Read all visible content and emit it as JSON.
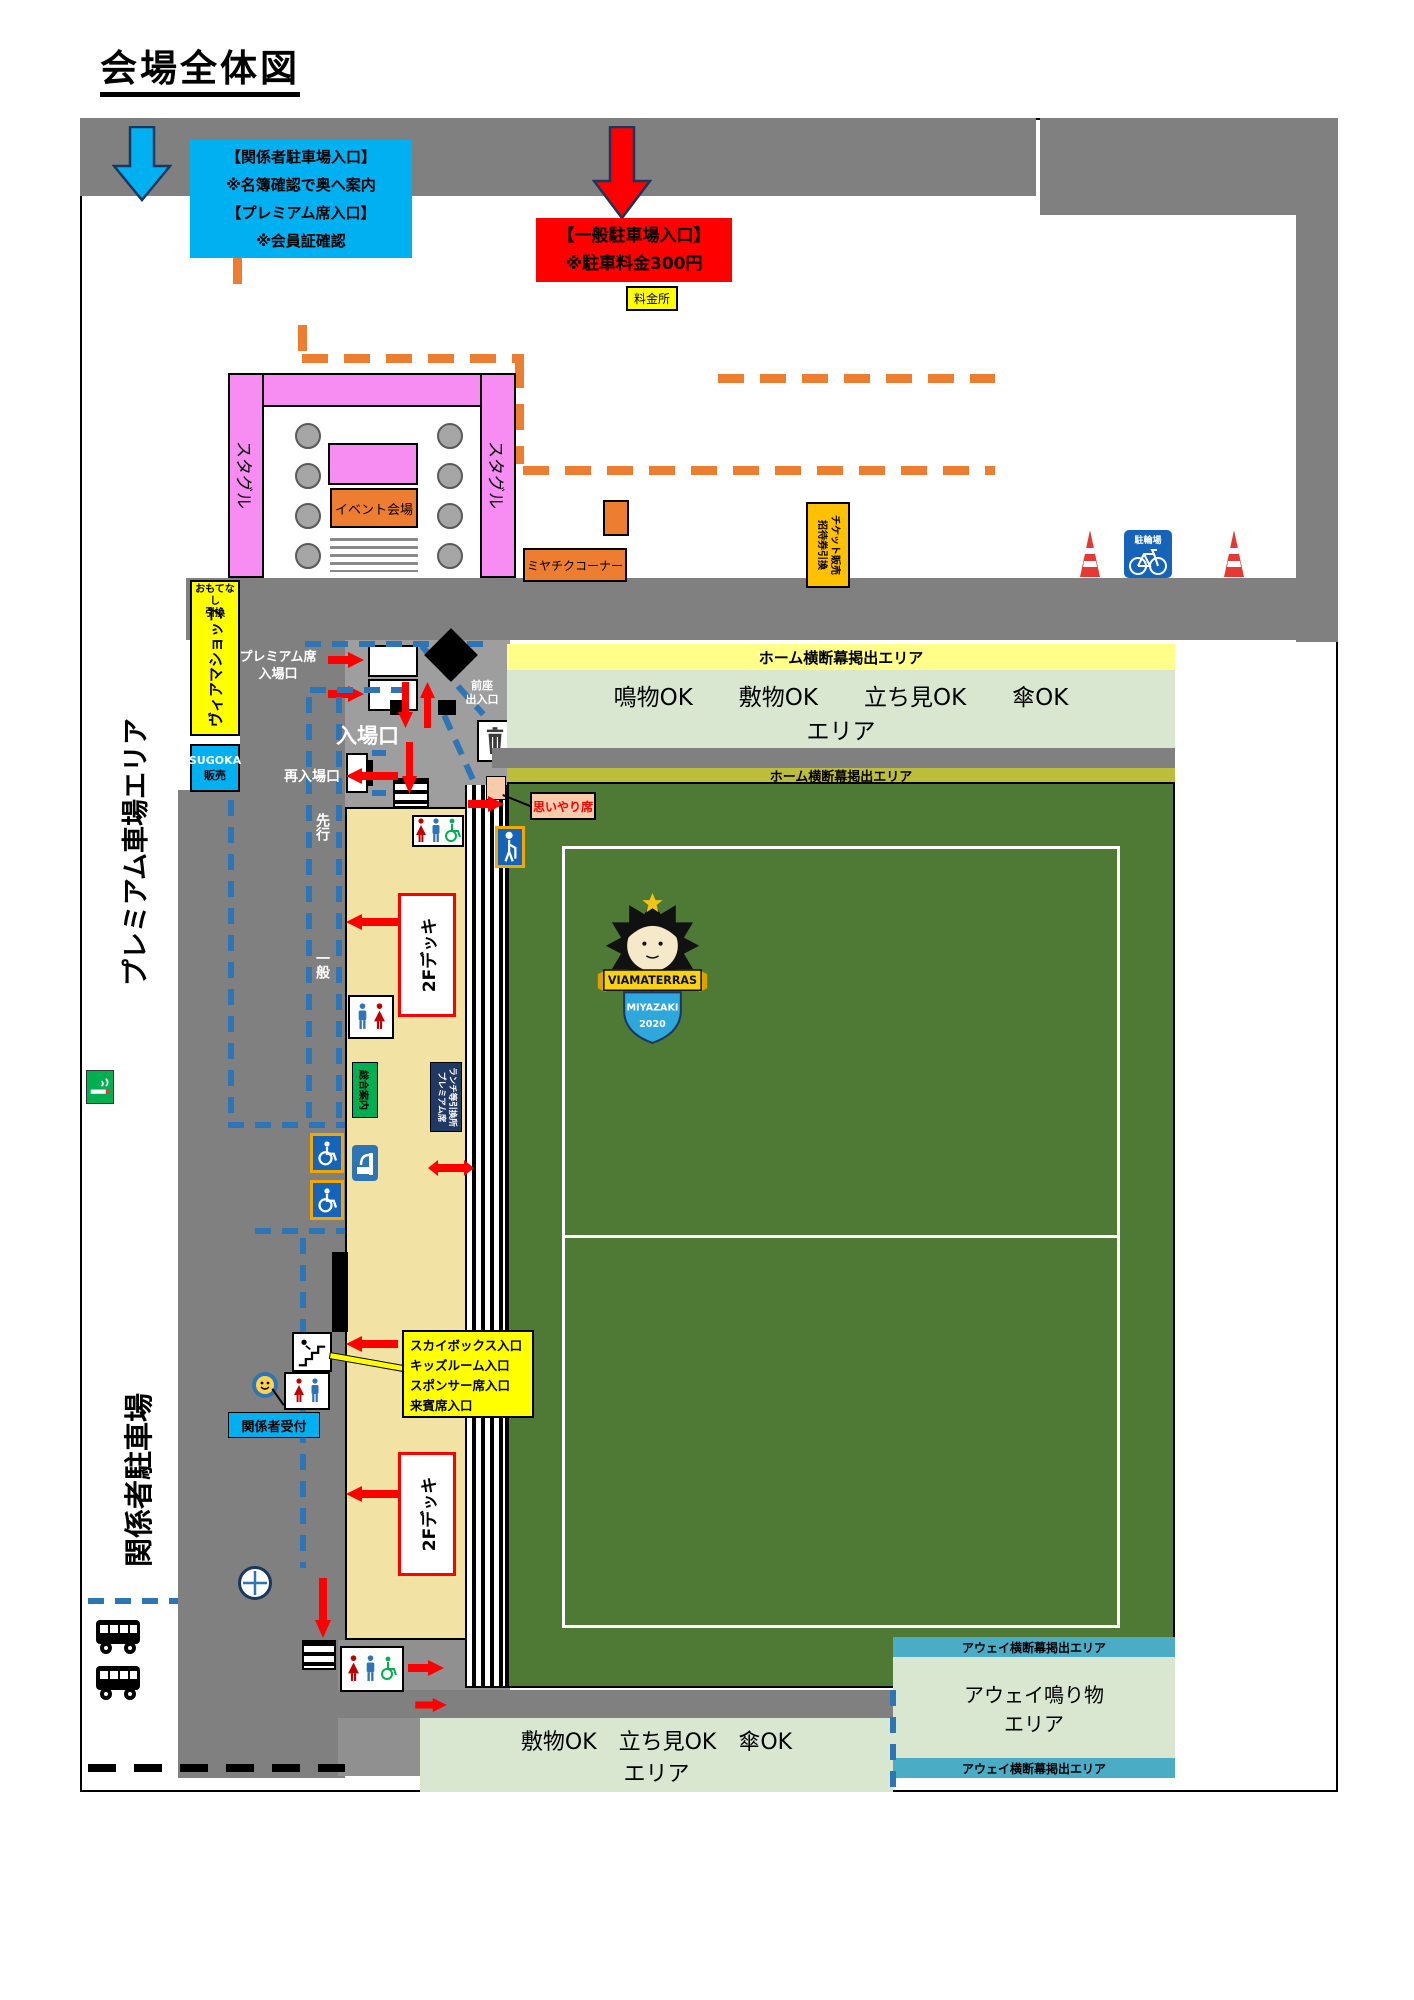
{
  "page": {
    "title": "会場全体図"
  },
  "colors": {
    "road": "#808080",
    "stand": "#F2E3A4",
    "field": "#4E7A35",
    "pink": "#F78CF2",
    "orange": "#ED7D31",
    "cyan": "#00B0F0",
    "red": "#FF0000",
    "yellow": "#FFFF00",
    "amber": "#FFC000",
    "pale_green": "#D9E7D0",
    "banner_yellow": "#FFFF8A",
    "banner_olive": "#BDBD3C",
    "teal": "#4BACC6",
    "green_sign": "#00B050",
    "navy": "#1F3864",
    "sign_blue": "#1663BA"
  },
  "top": {
    "staff_parking_box": {
      "lines": [
        "【関係者駐車場入口】",
        "※名簿確認で奥へ案内",
        "【プレミアム席入口】",
        "※会員証確認"
      ]
    },
    "general_parking_box": {
      "lines": [
        "【一般駐車場入口】",
        "※駐車料金300円"
      ]
    },
    "toll_booth": "料金所"
  },
  "plaza": {
    "stagle": "スタグル",
    "event_venue": "イベント会場",
    "miyachiku_corner": "ミヤチクコーナー",
    "ticket_booth": {
      "right_column": "チケット販売",
      "left_column": "招待券引換"
    },
    "bike_parking": "駐輪場"
  },
  "left": {
    "premium_car_area": "プレミアム車場エリア",
    "staff_parking": "関係者駐車場",
    "omotenashi": {
      "line1": "おもてなし",
      "line2": "引換"
    },
    "via_shop": "ヴィアマショップ",
    "sugoka": {
      "line1": "SUGOKA",
      "line2": "販売"
    }
  },
  "entrance": {
    "premium_gate": {
      "line1": "プレミアム席",
      "line2": "入場口"
    },
    "main_gate": "入場口",
    "reentry_gate": "再入場口",
    "zenza_gate": {
      "line1": "前座",
      "line2": "出入口"
    },
    "priority_lane": "先行",
    "general_lane": "一般",
    "omoiyari_seat": "思いやり席"
  },
  "stand": {
    "deck_2f": "2Fデッキ",
    "info_center": "総合案内",
    "premium_exchange": {
      "right_column": "ランチ等引換所",
      "left_column": "プレミアム席"
    },
    "skybox_callout": {
      "lines": [
        "スカイボックス入口",
        "キッズルーム入口",
        "スポンサー席入口",
        "来賓席入口"
      ]
    },
    "staff_reception": "関係者受付"
  },
  "field": {
    "home_banner_area": "ホーム横断幕掲出エリア",
    "home_free_area": {
      "line1": "鳴物OK　　敷物OK　　立ち見OK　　傘OK",
      "line2": "エリア"
    },
    "bottom_free_area": {
      "line1": "敷物OK　立ち見OK　傘OK",
      "line2": "エリア"
    },
    "away_area": {
      "line1": "アウェイ鳴り物",
      "line2": "エリア"
    },
    "away_banner_area": "アウェイ横断幕掲出エリア",
    "logo": {
      "team": "VIAMATERRAS",
      "city": "MIYAZAKI",
      "year": "2020"
    }
  },
  "icons": [
    "bus-icon",
    "bicycle-parking-icon",
    "traffic-cone-icon",
    "trash-icon",
    "toilet-man-icon",
    "toilet-woman-icon",
    "wheelchair-icon",
    "priority-seat-icon",
    "drinking-fountain-icon",
    "stairs-icon",
    "smiley-icon",
    "smoking-icon",
    "crosshair-icon",
    "down-arrow-icon",
    "diamond-marker-icon"
  ]
}
